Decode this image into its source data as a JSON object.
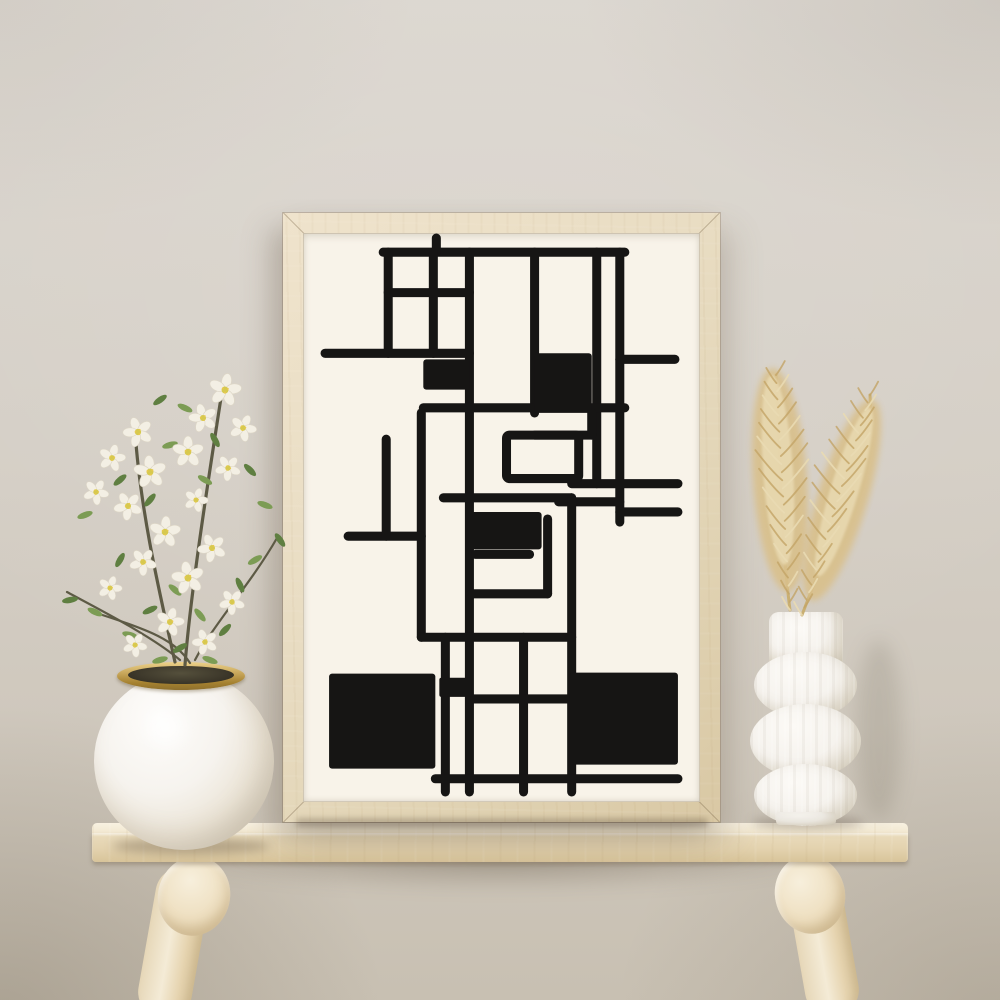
{
  "scene": {
    "description": "Product-style interior photo: a light oak frame holding a black abstract geometric line print leans against a warm beige plaster wall on a pale wooden stool bench, with a round white vase of white blossom branches on the left and a white ribbed bubble vase holding two dried pampas grass plumes on the right.",
    "objects": {
      "wall": {
        "label": "beige plaster wall"
      },
      "frame": {
        "label": "light oak picture frame"
      },
      "artwork": {
        "label": "abstract geometric black line art print",
        "style": "rectilinear maze-like composition with solid black blocks on cream paper"
      },
      "table": {
        "label": "pale wood bench with round splayed legs"
      },
      "left_vase": {
        "label": "round white sphere vase with brass rim"
      },
      "blossoms": {
        "label": "white cherry blossom branches with green leaves"
      },
      "right_vase": {
        "label": "white ribbed bubble vase"
      },
      "pampas": {
        "label": "two dried pampas grass plumes"
      }
    }
  },
  "colors": {
    "wall_top": "#dbd6cf",
    "wall_mid": "#d5cfc6",
    "wall_bottom": "#c8c0b2",
    "paper": "#f8f3e9",
    "ink": "#161514",
    "frame_wood": "#e9ddc3",
    "frame_wood_dark": "#d9c8a4",
    "table_light": "#f1e6cd",
    "table_mid": "#eadcbd",
    "table_dark": "#d8c49a",
    "leg_light": "#f4ebd6",
    "leg_dark": "#d9c69e",
    "vase_white": "#f6f3ee",
    "vase_shade": "#d9d2c3",
    "brass": "#c3a155",
    "brass_dark": "#8d6f2e",
    "vase_opening": "#3f3a2c",
    "leaf": "#7c9c54",
    "leaf_dark": "#5f7f41",
    "stem": "#5d5a45",
    "petal": "#f3efe4",
    "petal_shade": "#ddd6c6",
    "flower_center": "#d6c94f",
    "pampas_main": "#d9c08b",
    "pampas_light": "#e9dab2",
    "pampas_dark": "#c3a467"
  },
  "plant": {
    "flowers": [
      [
        170,
        30,
        1.15,
        10
      ],
      [
        148,
        58,
        1.0,
        -15
      ],
      [
        188,
        68,
        0.95,
        25
      ],
      [
        133,
        92,
        1.1,
        0
      ],
      [
        173,
        108,
        0.9,
        40
      ],
      [
        83,
        72,
        1.05,
        -20
      ],
      [
        57,
        98,
        0.95,
        15
      ],
      [
        95,
        112,
        1.15,
        -5
      ],
      [
        41,
        132,
        0.9,
        30
      ],
      [
        73,
        146,
        1.0,
        -30
      ],
      [
        141,
        140,
        0.85,
        20
      ],
      [
        110,
        172,
        1.1,
        5
      ],
      [
        157,
        188,
        1.0,
        -25
      ],
      [
        88,
        202,
        0.95,
        35
      ],
      [
        133,
        218,
        1.15,
        -10
      ],
      [
        55,
        228,
        0.85,
        20
      ],
      [
        177,
        242,
        0.9,
        -35
      ],
      [
        115,
        262,
        1.0,
        15
      ],
      [
        150,
        282,
        0.9,
        -20
      ],
      [
        80,
        285,
        0.85,
        30
      ]
    ],
    "leaves": [
      [
        105,
        40,
        -35,
        1
      ],
      [
        130,
        48,
        25,
        0
      ],
      [
        160,
        80,
        60,
        1
      ],
      [
        115,
        85,
        -15,
        0
      ],
      [
        95,
        140,
        -50,
        1
      ],
      [
        150,
        120,
        30,
        0
      ],
      [
        195,
        110,
        45,
        1
      ],
      [
        210,
        145,
        20,
        0
      ],
      [
        225,
        180,
        55,
        1
      ],
      [
        200,
        200,
        -30,
        0
      ],
      [
        65,
        120,
        -40,
        1
      ],
      [
        30,
        155,
        -20,
        0
      ],
      [
        15,
        240,
        -10,
        1
      ],
      [
        40,
        252,
        25,
        0
      ],
      [
        65,
        200,
        -60,
        1
      ],
      [
        120,
        230,
        40,
        0
      ],
      [
        95,
        250,
        -25,
        1
      ],
      [
        145,
        255,
        50,
        0
      ],
      [
        170,
        270,
        -45,
        1
      ],
      [
        75,
        275,
        15,
        0
      ],
      [
        125,
        288,
        -30,
        1
      ],
      [
        155,
        300,
        20,
        0
      ],
      [
        185,
        225,
        65,
        1
      ],
      [
        105,
        300,
        -15,
        0
      ]
    ],
    "stems": [
      "M130,305 C135,240 150,140 168,25",
      "M120,302 C105,235 85,150 80,70",
      "M125,300 C95,275 45,250 12,232",
      "M140,300 C160,262 195,225 222,178",
      "M135,303 C120,280 95,270 38,252"
    ]
  },
  "pampas_plumes": [
    {
      "x1": 100,
      "y1": 290,
      "x2": 86,
      "y2": 55,
      "spread": 27,
      "count": 30
    },
    {
      "x1": 112,
      "y1": 295,
      "x2": 180,
      "y2": 75,
      "spread": 25,
      "count": 30
    }
  ]
}
